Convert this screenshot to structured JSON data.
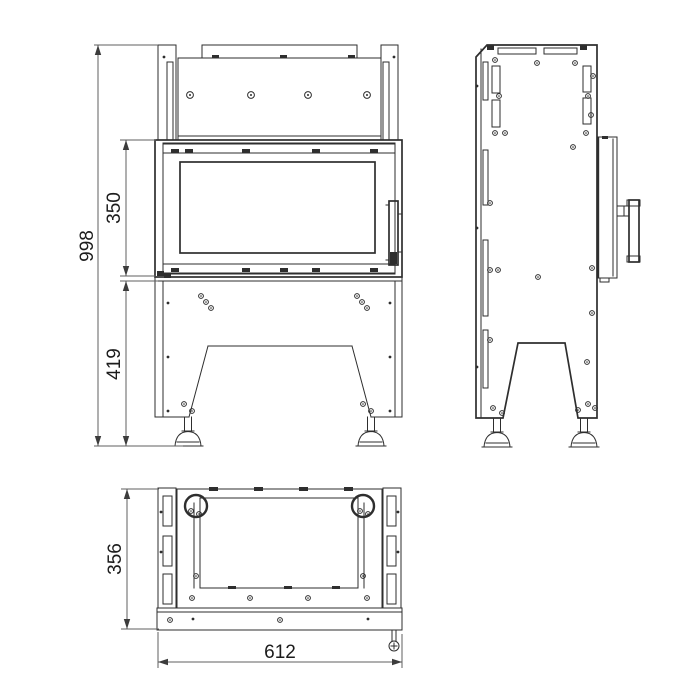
{
  "drawing": {
    "dimensions": {
      "overall_height": "998",
      "door_height": "350",
      "base_height": "419",
      "depth": "356",
      "width": "612"
    }
  }
}
